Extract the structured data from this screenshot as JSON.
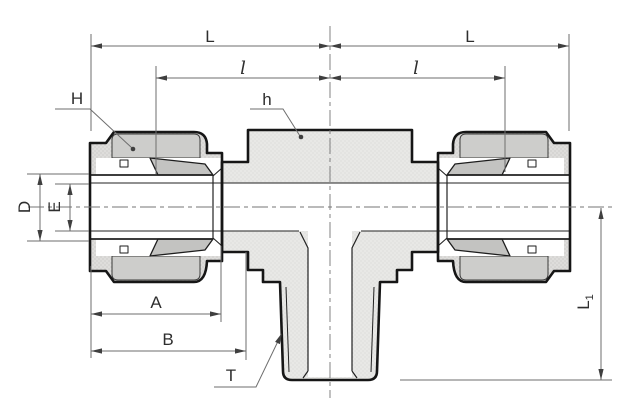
{
  "drawing": {
    "kind": "technical-drawing",
    "subject": "Sectioned side view of a male branch tee compression tube fitting with two nuts and a threaded bottom branch",
    "dimension_labels": {
      "L_left": "L",
      "L_right": "L",
      "l_left": "l",
      "l_right": "l",
      "H": "H",
      "h": "h",
      "D": "D",
      "E": "E",
      "A": "A",
      "B": "B",
      "T": "T",
      "L1_main": "L",
      "L1_sub": "1"
    },
    "colors": {
      "background": "#ffffff",
      "outline": "#161616",
      "body_fill": "#e8e8e6",
      "nut_fill": "#dedddb",
      "band_fill": "#cdcdcb",
      "ferrule_fill": "#c3c3c1",
      "white": "#ffffff",
      "dimension_line": "#6e6e6e",
      "arrow": "#3f3f3f",
      "centerline": "#767676"
    }
  }
}
